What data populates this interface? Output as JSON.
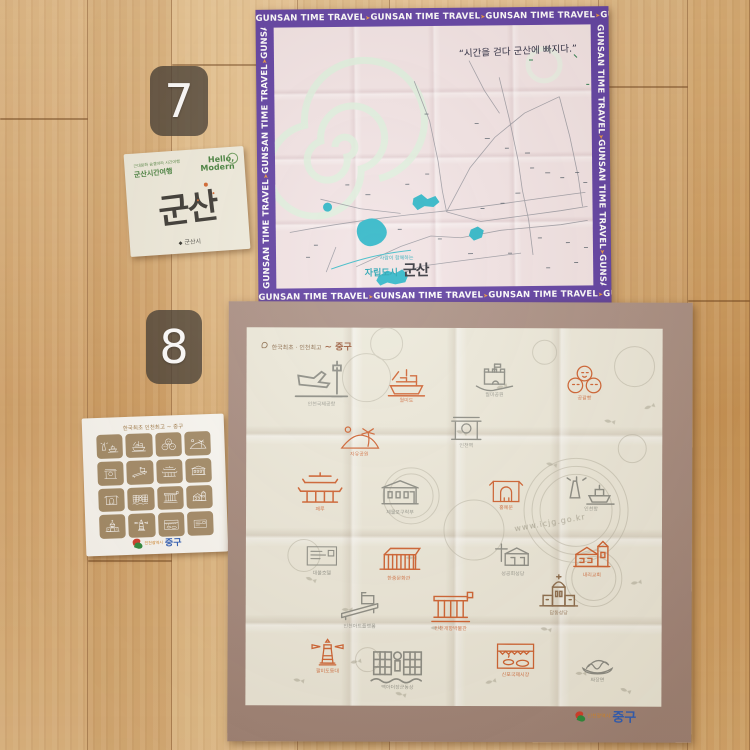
{
  "badges": {
    "seven": "7",
    "eight": "8"
  },
  "envelope_gunsan": {
    "tagline": "근대문화 숨결따라 시간여행",
    "brand": "군산시간여행",
    "hello_line1": "Hello,",
    "hello_line2": "Modern",
    "title_calligraphy": "군산",
    "publisher": "군산시"
  },
  "handkerchief_gunsan": {
    "border_text": "GUNSAN TIME TRAVEL",
    "quote": "“시간을 걷다 군산에 빠지다.”",
    "slogan_small": "사람이 함께하는",
    "slogan": "자립도시",
    "city_calligraphy": "군산",
    "colors": {
      "border": "#5b3aa0",
      "cloth": "#f2e3e4",
      "water": "#27b4c6",
      "spiral": "#dff0de"
    }
  },
  "envelope_junggu": {
    "header": "한국최초 인천최고 ~ 중구",
    "footer_city": "인천광역시",
    "footer_gu": "중구",
    "tile_glyphs": [
      "harbor",
      "ship",
      "buns",
      "hill",
      "gate",
      "slope",
      "paifang",
      "clubhouse",
      "arch",
      "statue",
      "columns",
      "church",
      "cathedral",
      "lighthouse",
      "market",
      "hotelbox"
    ]
  },
  "handkerchief_junggu": {
    "header_small": "한국최초 · 인천최고",
    "header_calligraphy": "~ 중구",
    "watermark": "www.icjg.go.kr",
    "footer_city": "인천광역시",
    "footer_gu": "중구",
    "colors": {
      "border": "#a98e82",
      "cloth": "#edeadb",
      "gray": "#8a8b83",
      "orange": "#cf5f2d",
      "brown": "#8a6a4a"
    },
    "landmarks": [
      {
        "label": "인천국제공항",
        "glyph": "airport",
        "color": "gray",
        "x": 44,
        "y": 30,
        "s": 62
      },
      {
        "label": "월미도",
        "glyph": "ship",
        "color": "orange",
        "x": 136,
        "y": 36,
        "s": 48
      },
      {
        "label": "월미공원",
        "glyph": "fort",
        "color": "gray",
        "x": 224,
        "y": 30,
        "s": 48
      },
      {
        "label": "공갈빵",
        "glyph": "buns",
        "color": "orange",
        "x": 316,
        "y": 36,
        "s": 44
      },
      {
        "label": "자유공원",
        "glyph": "hill",
        "color": "orange",
        "x": 92,
        "y": 94,
        "s": 42
      },
      {
        "label": "인천역",
        "glyph": "gate",
        "color": "gray",
        "x": 198,
        "y": 84,
        "s": 44
      },
      {
        "label": "패루",
        "glyph": "paifang",
        "color": "orange",
        "x": 48,
        "y": 142,
        "s": 52
      },
      {
        "label": "제물포구락부",
        "glyph": "clubhouse",
        "color": "gray",
        "x": 130,
        "y": 148,
        "s": 48
      },
      {
        "label": "홍예문",
        "glyph": "arch",
        "color": "orange",
        "x": 238,
        "y": 146,
        "s": 44
      },
      {
        "label": "인천항",
        "glyph": "harbor",
        "color": "gray",
        "x": 320,
        "y": 142,
        "s": 50
      },
      {
        "label": "대불호텔",
        "glyph": "hotelbox",
        "color": "gray",
        "x": 54,
        "y": 212,
        "s": 44
      },
      {
        "label": "한중문화관",
        "glyph": "modern",
        "color": "orange",
        "x": 128,
        "y": 212,
        "s": 50
      },
      {
        "label": "성공회성당",
        "glyph": "churchcross",
        "color": "gray",
        "x": 244,
        "y": 210,
        "s": 46
      },
      {
        "label": "내리교회",
        "glyph": "church",
        "color": "orange",
        "x": 322,
        "y": 210,
        "s": 48
      },
      {
        "label": "인천아트플랫폼",
        "glyph": "slope",
        "color": "gray",
        "x": 90,
        "y": 262,
        "s": 48
      },
      {
        "label": "인천개항박물관",
        "glyph": "columns",
        "color": "orange",
        "x": 180,
        "y": 262,
        "s": 50
      },
      {
        "label": "답동성당",
        "glyph": "cathedral",
        "color": "brown",
        "x": 288,
        "y": 246,
        "s": 50
      },
      {
        "label": "팔미도등대",
        "glyph": "lighthouse",
        "color": "orange",
        "x": 60,
        "y": 310,
        "s": 44
      },
      {
        "label": "맥아더장군동상",
        "glyph": "statue",
        "color": "gray",
        "x": 122,
        "y": 314,
        "s": 60
      },
      {
        "label": "신포국제시장",
        "glyph": "market",
        "color": "orange",
        "x": 246,
        "y": 310,
        "s": 48
      },
      {
        "label": "짜장면",
        "glyph": "noodles",
        "color": "gray",
        "x": 330,
        "y": 318,
        "s": 44
      }
    ]
  }
}
